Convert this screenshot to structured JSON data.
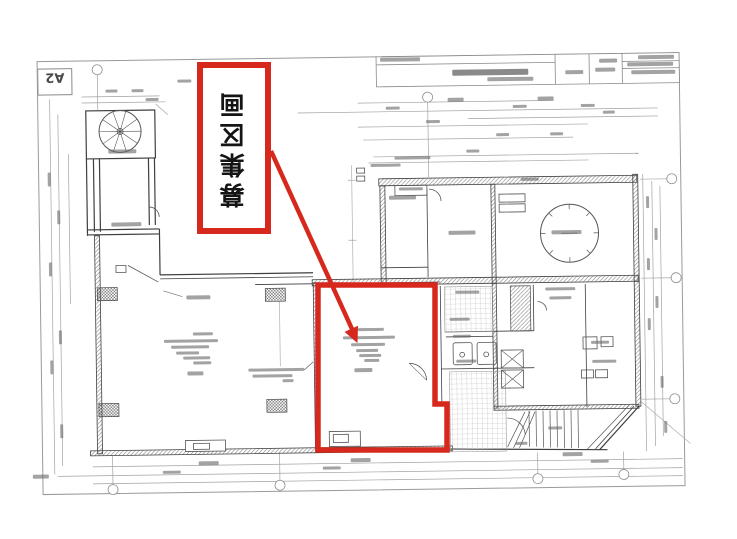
{
  "sheet": {
    "label": "A2"
  },
  "annotation": {
    "text": "募集区画"
  },
  "colors": {
    "annotation_red": "#d7281d"
  },
  "drawing": {
    "type": "architectural-floor-plan",
    "orientation": "scanned upside down (rotated 180°)"
  }
}
